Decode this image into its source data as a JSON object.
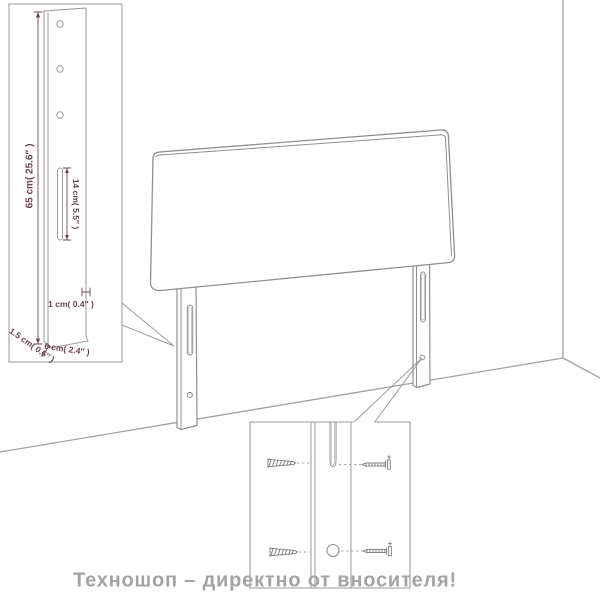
{
  "watermark": {
    "text": "Техношоп – директно от вносителя!",
    "color": "#a3a3a3"
  },
  "diagram": {
    "type": "product-assembly-diagram",
    "subject": "bed headboard with two slotted legs",
    "side_view_inset": {
      "height_label": "65 cm( 25.6″ )",
      "slot_length_label": "14 cm( 5.5″ )",
      "hole_label": "1 cm( 0.4″ )",
      "thickness_label": "1.5 cm( 0.6″ )",
      "width_label": "6 cm( 2.4″ )",
      "hole_count": 3
    },
    "hardware_inset": {
      "screw_count": 4,
      "parts": [
        "wood-screw-left-top",
        "wood-screw-left-bottom",
        "machine-screw-right-top",
        "machine-screw-right-bottom",
        "leg-slot",
        "leg-hole"
      ]
    },
    "colors": {
      "outline": "#909090",
      "inset_border": "#999999",
      "dimension": "#6d4156",
      "dashed_leader": "#a5a5a5"
    }
  }
}
